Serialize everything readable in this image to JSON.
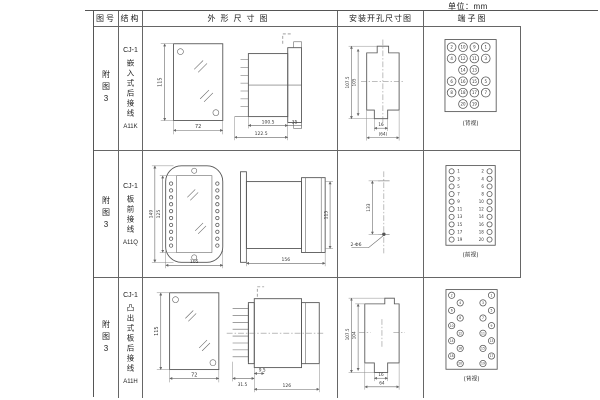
{
  "unit_label": "单位：mm",
  "table": {
    "headers": {
      "figure_no": "图号",
      "structure": "结构",
      "outline": "外形尺寸图",
      "install": "安装开孔尺寸图",
      "terminal": "端子图"
    }
  },
  "rows": [
    {
      "figure_no": "附图3",
      "structure": {
        "model": "CJ-1",
        "desc": "嵌入式后接线",
        "code": "A11K"
      },
      "outline": {
        "front_height": "115",
        "front_width": "72",
        "body_len": "100.5",
        "total_len": "122.5",
        "flange": "35"
      },
      "install": {
        "outer_height": "107.5",
        "inner_height": "105",
        "slot_width": "16",
        "total_width": "(64)"
      },
      "terminal_view": "(背视)"
    },
    {
      "figure_no": "附图3",
      "structure": {
        "model": "CJ-1",
        "desc": "板前接线",
        "code": "A11Q"
      },
      "outline": {
        "outer_height": "149",
        "inner_height": "125",
        "front_width": "105",
        "body_len": "156",
        "side_height": "115"
      },
      "install": {
        "hole_spacing": "133",
        "hole_label": "2-Φ6"
      },
      "terminal_view": "(前视)"
    },
    {
      "figure_no": "附图3",
      "structure": {
        "model": "CJ-1",
        "desc": "凸出式板后接线",
        "code": "A11H"
      },
      "outline": {
        "front_height": "115",
        "front_width": "72",
        "pin_len": "31.5",
        "gap": "9.5",
        "body_len": "126"
      },
      "install": {
        "outer_height": "107.5",
        "inner_height": "104",
        "slot_width": "16",
        "total_width": "64"
      },
      "terminal_view": "(背视)"
    }
  ],
  "terminals": {
    "t1": {
      "grid": [
        [
          "2",
          "10",
          "9",
          "1"
        ],
        [
          "4",
          "12",
          "11",
          "3"
        ],
        [
          "",
          "14",
          "13",
          ""
        ],
        [
          "6",
          "16",
          "15",
          "5"
        ],
        [
          "8",
          "18",
          "17",
          "7"
        ],
        [
          "",
          "20",
          "19",
          ""
        ]
      ]
    },
    "t2": {
      "left": [
        "1",
        "3",
        "5",
        "7",
        "9",
        "11",
        "13",
        "15",
        "17",
        "19"
      ],
      "right": [
        "2",
        "4",
        "6",
        "8",
        "10",
        "12",
        "14",
        "16",
        "18",
        "20"
      ]
    },
    "t3": {
      "left_outer": [
        "2",
        "6",
        "10",
        "14",
        "18"
      ],
      "left_inner": [
        "4",
        "8",
        "12",
        "16",
        "20"
      ],
      "right_inner": [
        "3",
        "7",
        "11",
        "15",
        "19"
      ],
      "right_outer": [
        "1",
        "5",
        "9",
        "13",
        "17"
      ]
    }
  }
}
